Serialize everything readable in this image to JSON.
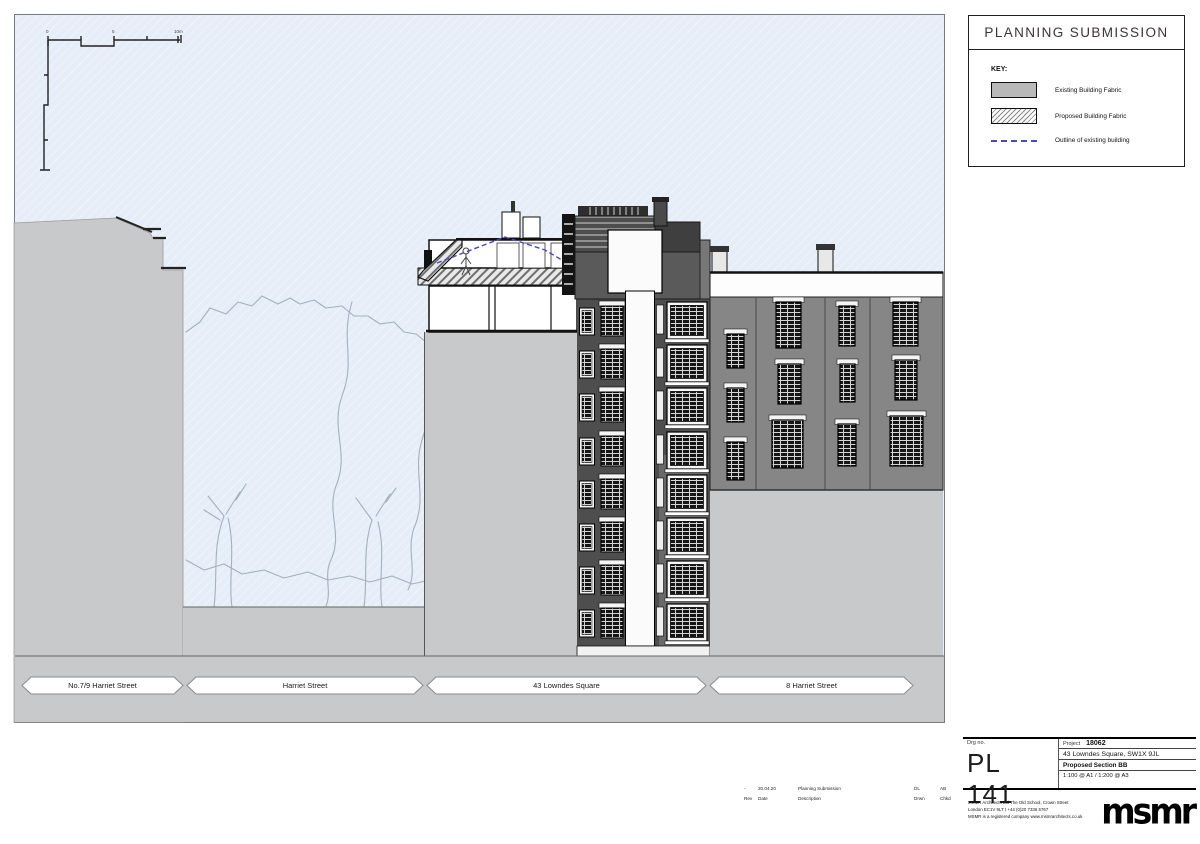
{
  "legend": {
    "title": "PLANNING SUBMISSION",
    "key_label": "KEY:",
    "items": [
      {
        "id": "existing",
        "label": "Existing Building Fabric"
      },
      {
        "id": "proposed",
        "label": "Proposed Building Fabric"
      },
      {
        "id": "outline",
        "label": "Outline of existing building"
      }
    ]
  },
  "banners": [
    "No.7/9 Harriet Street",
    "Harriet Street",
    "43 Lowndes Square",
    "8 Harriet Street"
  ],
  "scalebar": {
    "zero": "0",
    "mid": "5",
    "end": "10m"
  },
  "revision": {
    "row": {
      "rev": "-",
      "date": "20.04.20",
      "description": "Planning Submission",
      "drawn": "DL",
      "checked": "AB"
    },
    "headers": {
      "rev": "Rev",
      "date": "Date",
      "description": "Description",
      "drawn": "Drwn",
      "checked": "Chkd"
    }
  },
  "titleblock": {
    "drg_label": "Drg no.",
    "drawing_number": "PL 141",
    "project_label": "Project",
    "project_number": "18062",
    "project_address": "43 Lowndes Square, SW1X 9JL",
    "drawing_title": "Proposed Section BB",
    "scale_text": "1:100 @ A1 / 1:200 @ A3",
    "firm_lines": [
      "MSMR Architects Ltd   The Old School, Crown Street",
      "London EC1V 9LT   t +44 (0)20 7336 5767",
      "MSMR is a registered company   www.msmrarchitects.co.uk"
    ],
    "logo_text": "msmr"
  },
  "colors": {
    "sky": "#e4edf8",
    "massing_gray": "#c7c9ca",
    "dark_facade": "#4e4e4e",
    "right_facade": "#868686",
    "outline_dash": "#4848be"
  }
}
